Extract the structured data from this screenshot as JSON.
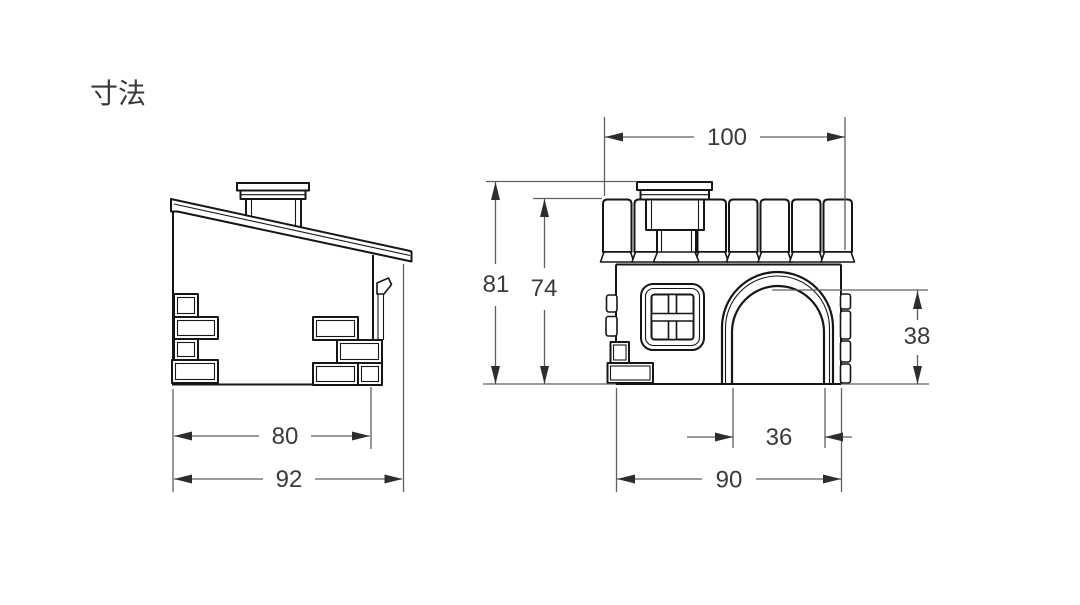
{
  "title": "寸法",
  "colors": {
    "background": "#ffffff",
    "outline": "#161616",
    "dimension_line": "#5f5f5f",
    "arrow": "#2d2d2d",
    "text": "#3a3a3a"
  },
  "side_view": {
    "inner_width": "80",
    "overall_width": "92"
  },
  "front_view": {
    "roof_width": "100",
    "overall_height": "81",
    "wall_height": "74",
    "door_height": "38",
    "door_width": "36",
    "body_width": "90"
  }
}
